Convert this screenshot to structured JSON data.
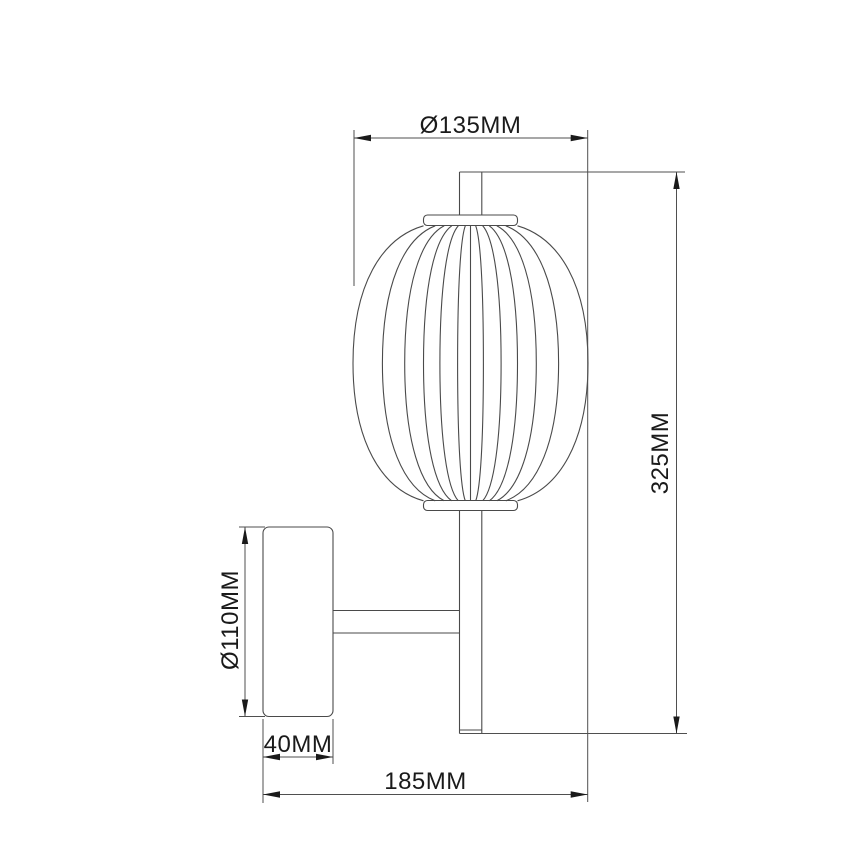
{
  "drawing": {
    "colors": {
      "background": "#ffffff",
      "line": "#4a4a4a",
      "dimension_line": "#4f4f4f",
      "arrow": "#1a1a1a",
      "text": "#1a1a1a"
    },
    "labels": {
      "shade_diameter": "Ø135MM",
      "overall_height": "325MM",
      "backplate_diameter": "Ø110MM",
      "backplate_depth": "40MM",
      "overall_projection": "185MM"
    }
  }
}
